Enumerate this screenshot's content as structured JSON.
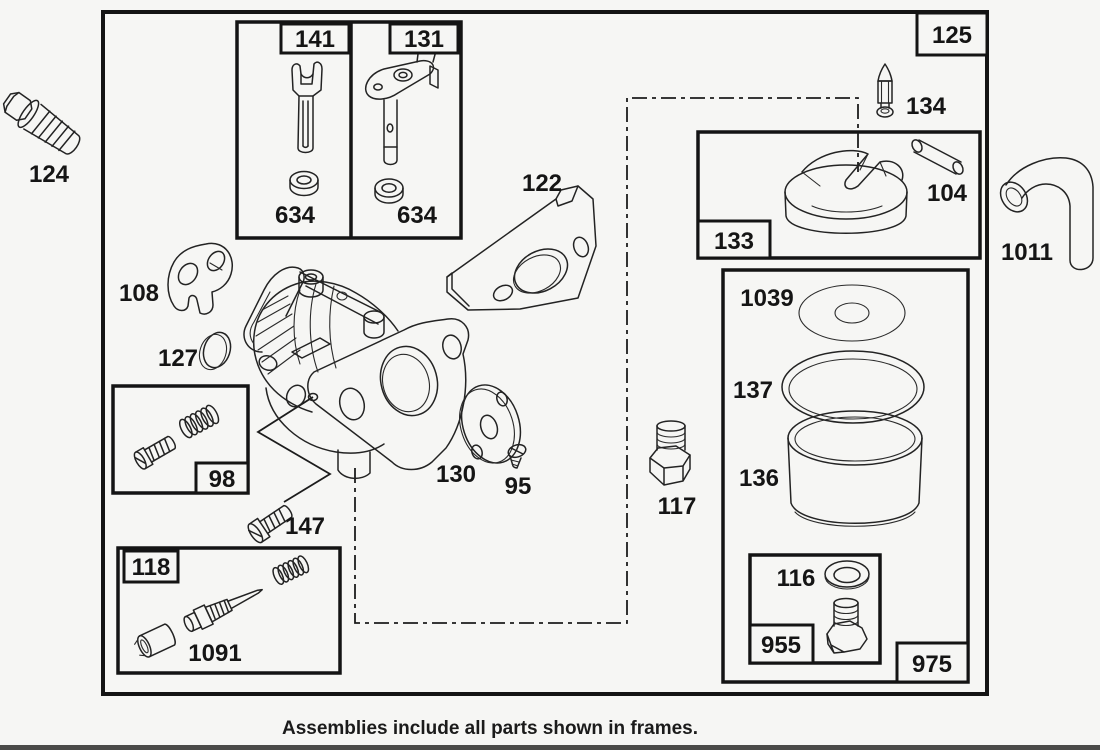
{
  "colors": {
    "background": "#f6f6f4",
    "ink": "#1e1e1e"
  },
  "caption": "Assemblies include all parts shown in frames.",
  "labels": {
    "l124": "124",
    "l141": "141",
    "l131": "131",
    "l634a": "634",
    "l634b": "634",
    "l125": "125",
    "l134": "134",
    "l104": "104",
    "l133": "133",
    "l122": "122",
    "l1011": "1011",
    "l108": "108",
    "l127": "127",
    "l98": "98",
    "l147": "147",
    "l130": "130",
    "l95": "95",
    "l117": "117",
    "l118": "118",
    "l1091": "1091",
    "l1039": "1039",
    "l137": "137",
    "l136": "136",
    "l116": "116",
    "l955": "955",
    "l975": "975"
  }
}
